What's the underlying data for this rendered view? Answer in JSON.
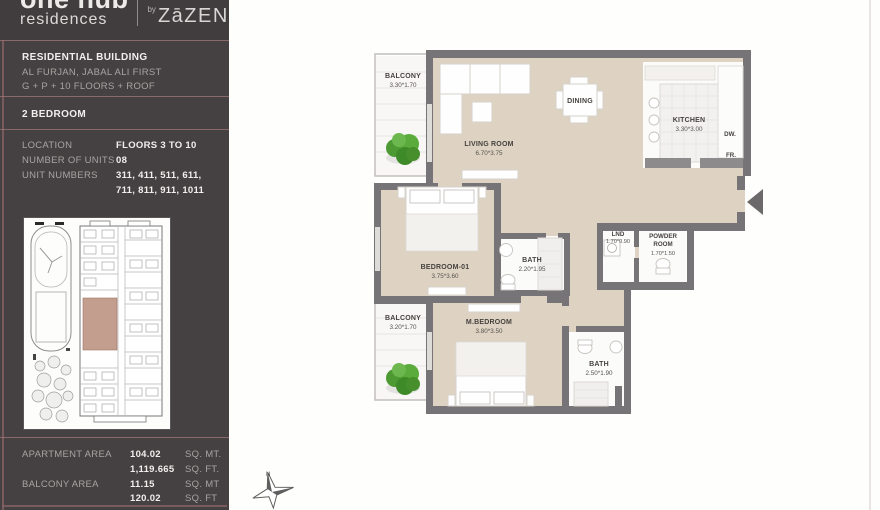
{
  "brand": {
    "logo_line1": "one hub",
    "logo_line2": "residences",
    "logo_by": "by",
    "logo_name": "ZāZEN"
  },
  "building": {
    "title": "RESIDENTIAL BUILDING",
    "address": "AL FURJAN, JABAL ALI FIRST",
    "floors": "G + P + 10 FLOORS + ROOF"
  },
  "unit_type": "2 BEDROOM",
  "specs": {
    "location_label": "LOCATION",
    "location_value": "FLOORS 3 TO 10",
    "units_label": "NUMBER OF UNITS",
    "units_value": "08",
    "unit_numbers_label": "UNIT NUMBERS",
    "unit_numbers_value1": "311, 411, 511, 611,",
    "unit_numbers_value2": "711, 811, 911, 1011"
  },
  "areas": {
    "apartment_label": "APARTMENT AREA",
    "apartment_sqm": "104.02",
    "apartment_sqm_unit": "SQ. MT.",
    "apartment_sqft": "1,119.665",
    "apartment_sqft_unit": "SQ. FT.",
    "balcony_label": "BALCONY AREA",
    "balcony_sqm": "11.15",
    "balcony_sqm_unit": "SQ. MT",
    "balcony_sqft": "120.02",
    "balcony_sqft_unit": "SQ. FT"
  },
  "floorplan": {
    "balcony_top": {
      "name": "BALCONY",
      "dim": "3.30*1.70"
    },
    "living": {
      "name": "LIVING ROOM",
      "dim": "6.70*3.75"
    },
    "dining": {
      "name": "DINING"
    },
    "kitchen": {
      "name": "KITCHEN",
      "dim": "3.30*3.00",
      "dw": "DW.",
      "fr": "FR."
    },
    "bedroom1": {
      "name": "BEDROOM-01",
      "dim": "3.75*3.60"
    },
    "bath1": {
      "name": "BATH",
      "dim": "2.20*1.95"
    },
    "lnd": {
      "name": "LND",
      "dim": "1.70*0.90"
    },
    "powder": {
      "name1": "POWDER",
      "name2": "ROOM",
      "dim": "1.70*1.50"
    },
    "balcony_bottom": {
      "name": "BALCONY",
      "dim": "3.20*1.70"
    },
    "mbedroom": {
      "name": "M.BEDROOM",
      "dim": "3.80*3.50"
    },
    "bath2": {
      "name": "BATH",
      "dim": "2.50*1.90"
    },
    "compass_n": "N"
  },
  "colors": {
    "sidebar_bg": "#454142",
    "sidebar_divider": "#9b7376",
    "floor_beige": "#ded3c2",
    "wall_gray": "#767476",
    "plant_green": "#4f9e33",
    "keyplan_highlight": "#b98d7a"
  }
}
